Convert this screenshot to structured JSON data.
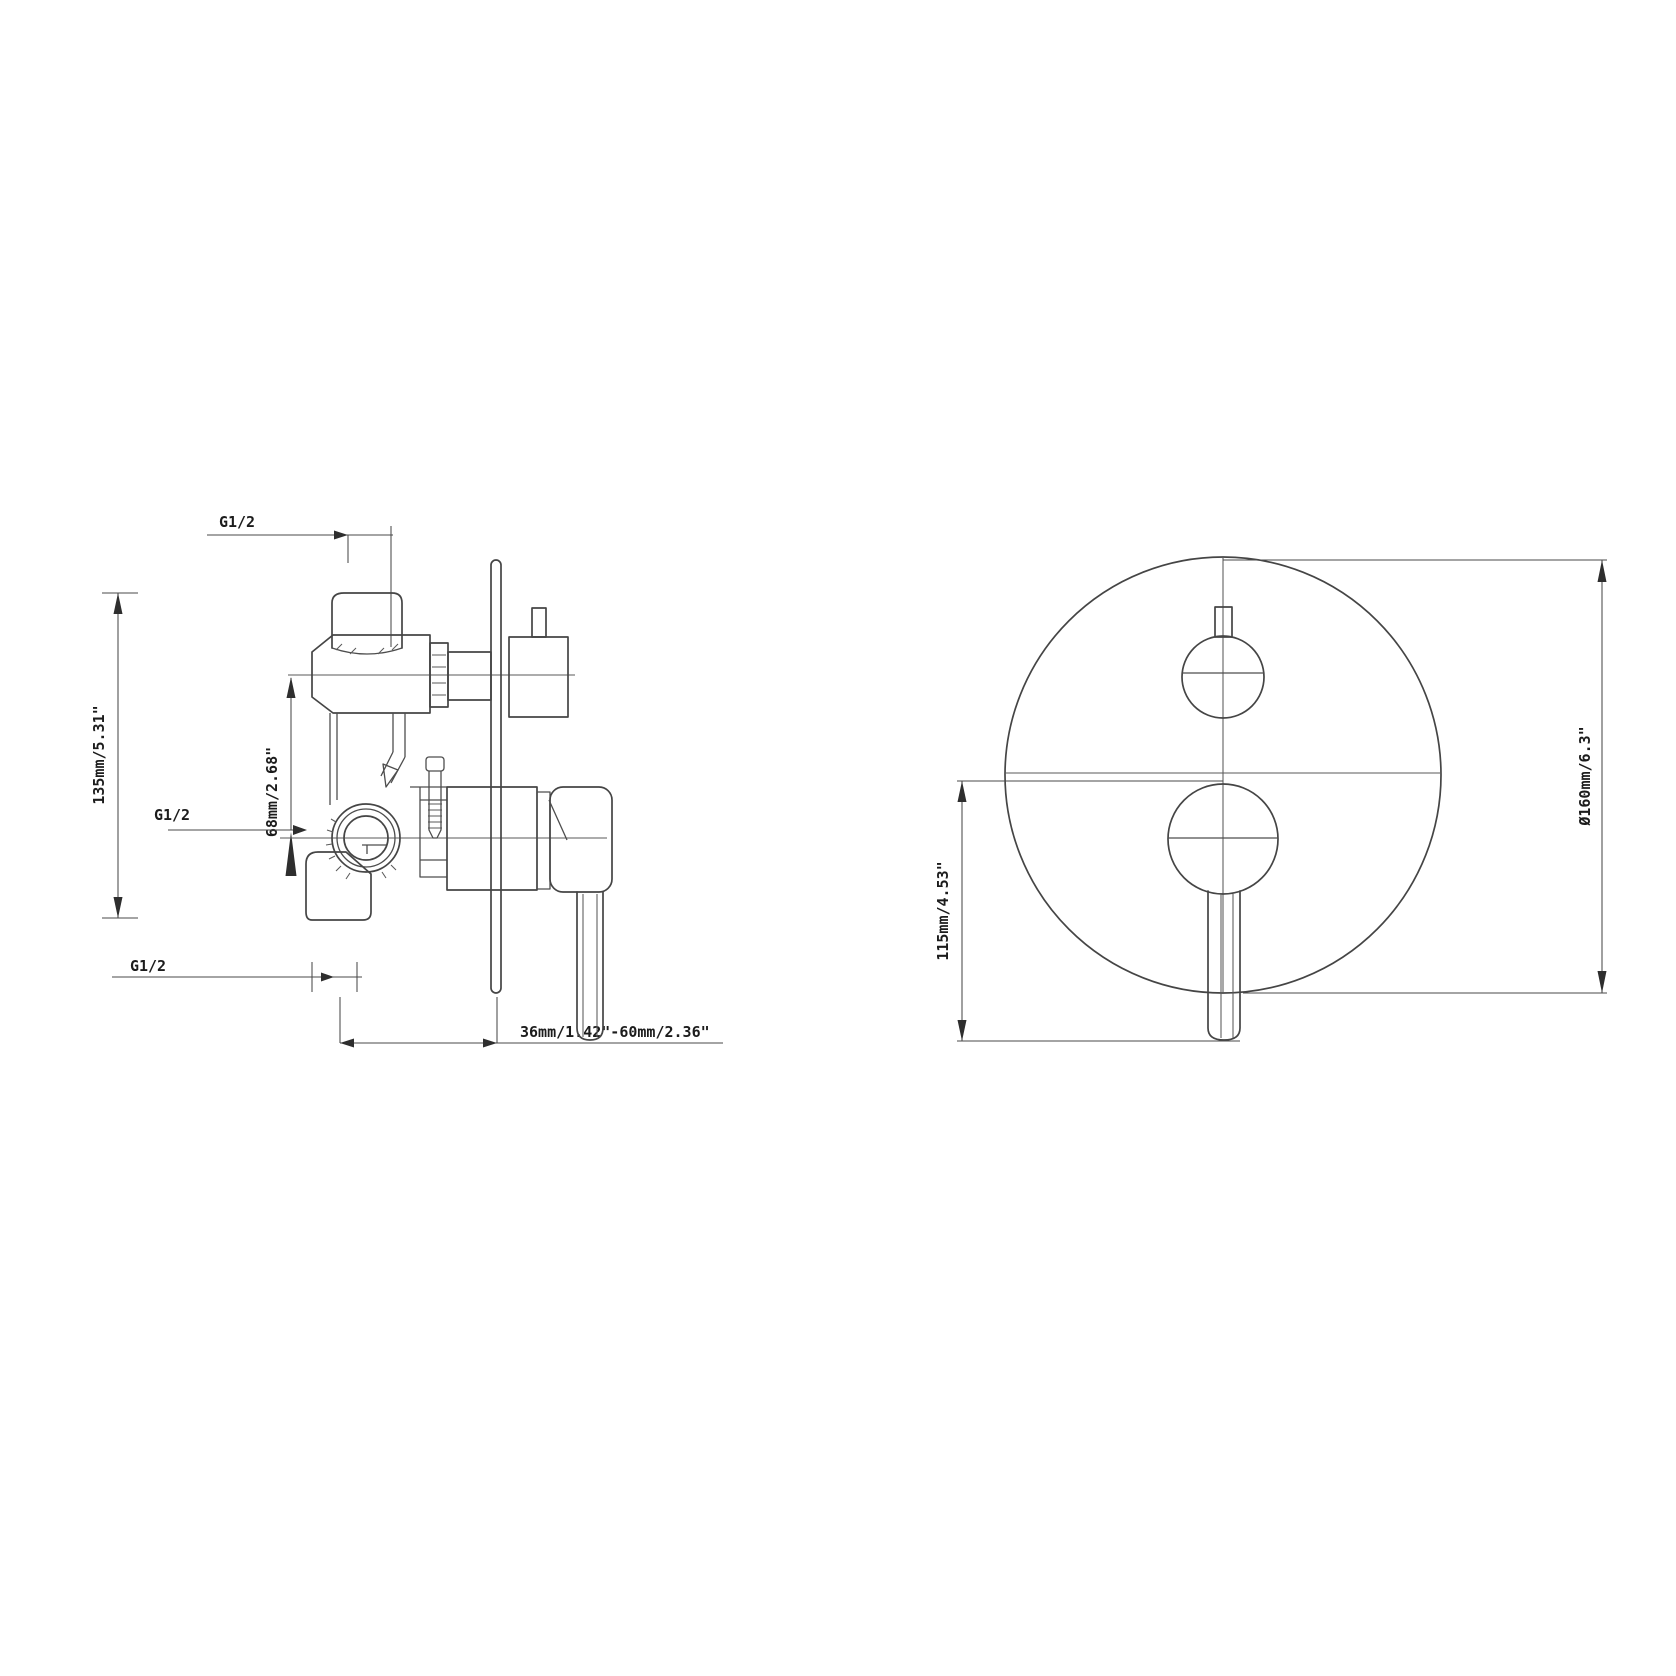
{
  "drawing": {
    "kind": "technical-installation-drawing",
    "subject": "concealed shower mixer valve, side section and front trim view"
  },
  "colors": {
    "background": "#ffffff",
    "line": "#4a4a4a",
    "text": "#1c1c1c"
  },
  "side_view": {
    "top_thread": "G1/2",
    "inlet_thread": "G1/2",
    "bottom_thread": "G1/2",
    "overall_height": "135mm/5.31\"",
    "port_offset": "68mm/2.68\"",
    "installation_depth_range": "36mm/1.42\"-60mm/2.36\""
  },
  "front_view": {
    "plate_diameter": "Ø160mm/6.3\"",
    "lever_offset": "115mm/4.53\""
  }
}
